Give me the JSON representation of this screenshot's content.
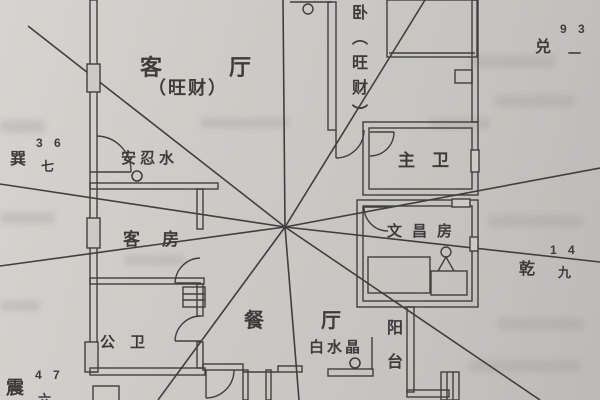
{
  "meta": {
    "description": "scanned feng-shui apartment floor plan with flying-star sector lines"
  },
  "rooms": {
    "living": {
      "label": "客厅",
      "note": "（旺财）"
    },
    "bedroom": {
      "label": "卧（旺财）"
    },
    "master_bath": {
      "label": "主卫"
    },
    "wenchang": {
      "label": "文昌房"
    },
    "guest": {
      "label": "客房"
    },
    "dining": {
      "label": "餐厅"
    },
    "public_bath": {
      "label": "公卫"
    },
    "balcony": {
      "label": "阳台"
    }
  },
  "remedies": {
    "anrenshui": {
      "label": "安忍水"
    },
    "baishuijing": {
      "label": "白水晶"
    }
  },
  "directions": {
    "xun": {
      "name": "巽",
      "numbers": "3 6",
      "star": "七"
    },
    "dui": {
      "name": "兑",
      "numbers": "9 3",
      "star": "一"
    },
    "qian": {
      "name": "乾",
      "numbers": "1 4",
      "star": "九"
    },
    "zhen": {
      "name": "震",
      "numbers": "4 7",
      "star": "六"
    }
  },
  "colors": {
    "ink": "#3a3a3a",
    "paper": "#cbc9c6"
  }
}
